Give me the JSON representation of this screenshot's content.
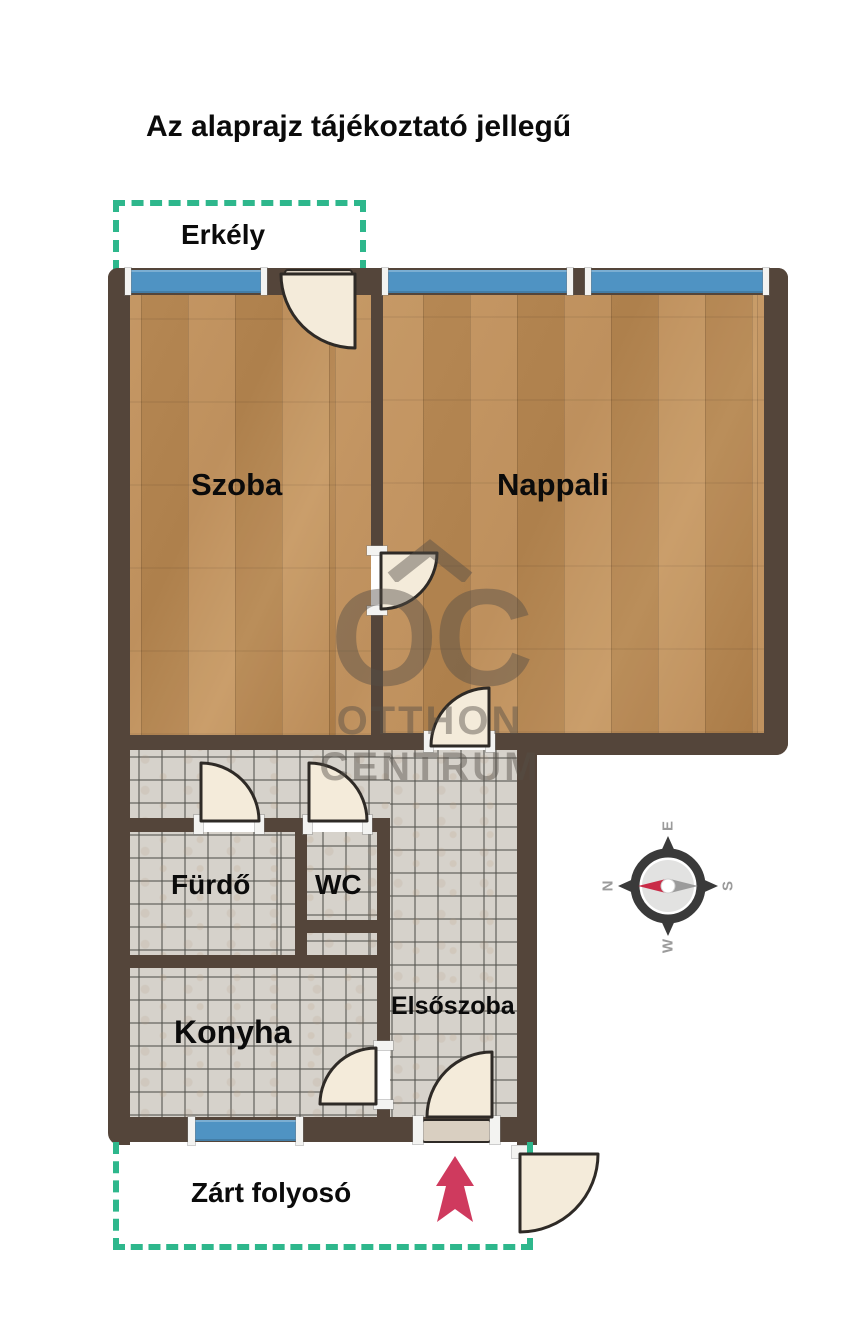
{
  "title": "Az alaprajz tájékoztató jellegű",
  "rooms": {
    "erkely": "Erkély",
    "szoba": "Szoba",
    "nappali": "Nappali",
    "furdo": "Fürdő",
    "wc": "WC",
    "konyha": "Konyha",
    "elsoszoba": "Elsőszoba",
    "zart_folyoso": "Zárt folyosó"
  },
  "watermark": {
    "monogram": "OC",
    "line1": "OTTHON",
    "line2": "CENTRUM"
  },
  "compass": {
    "north": "N",
    "east": "E",
    "south": "S",
    "west": "W"
  },
  "colors": {
    "wall": "#54453a",
    "wood_floor": "#bb8a52",
    "tile_floor": "#d6d2cb",
    "window_glass": "#4f93c3",
    "balcony_dash": "#2eb78c",
    "door_leaf": "#f4ebda",
    "entrance_arrow": "#cf3a5e",
    "compass_needle": "#c92b47"
  }
}
